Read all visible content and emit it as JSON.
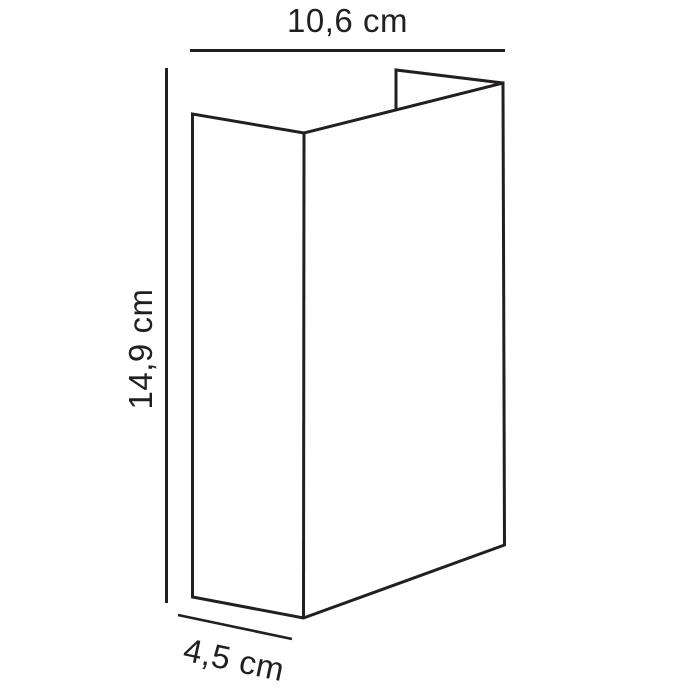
{
  "diagram": {
    "kind": "product-dimension-line-drawing",
    "labels": {
      "width": "10,6 cm",
      "height": "14,9 cm",
      "depth": "4,5 cm"
    },
    "colors": {
      "line": "#231f20",
      "text": "#231f20",
      "background": "#ffffff"
    }
  }
}
